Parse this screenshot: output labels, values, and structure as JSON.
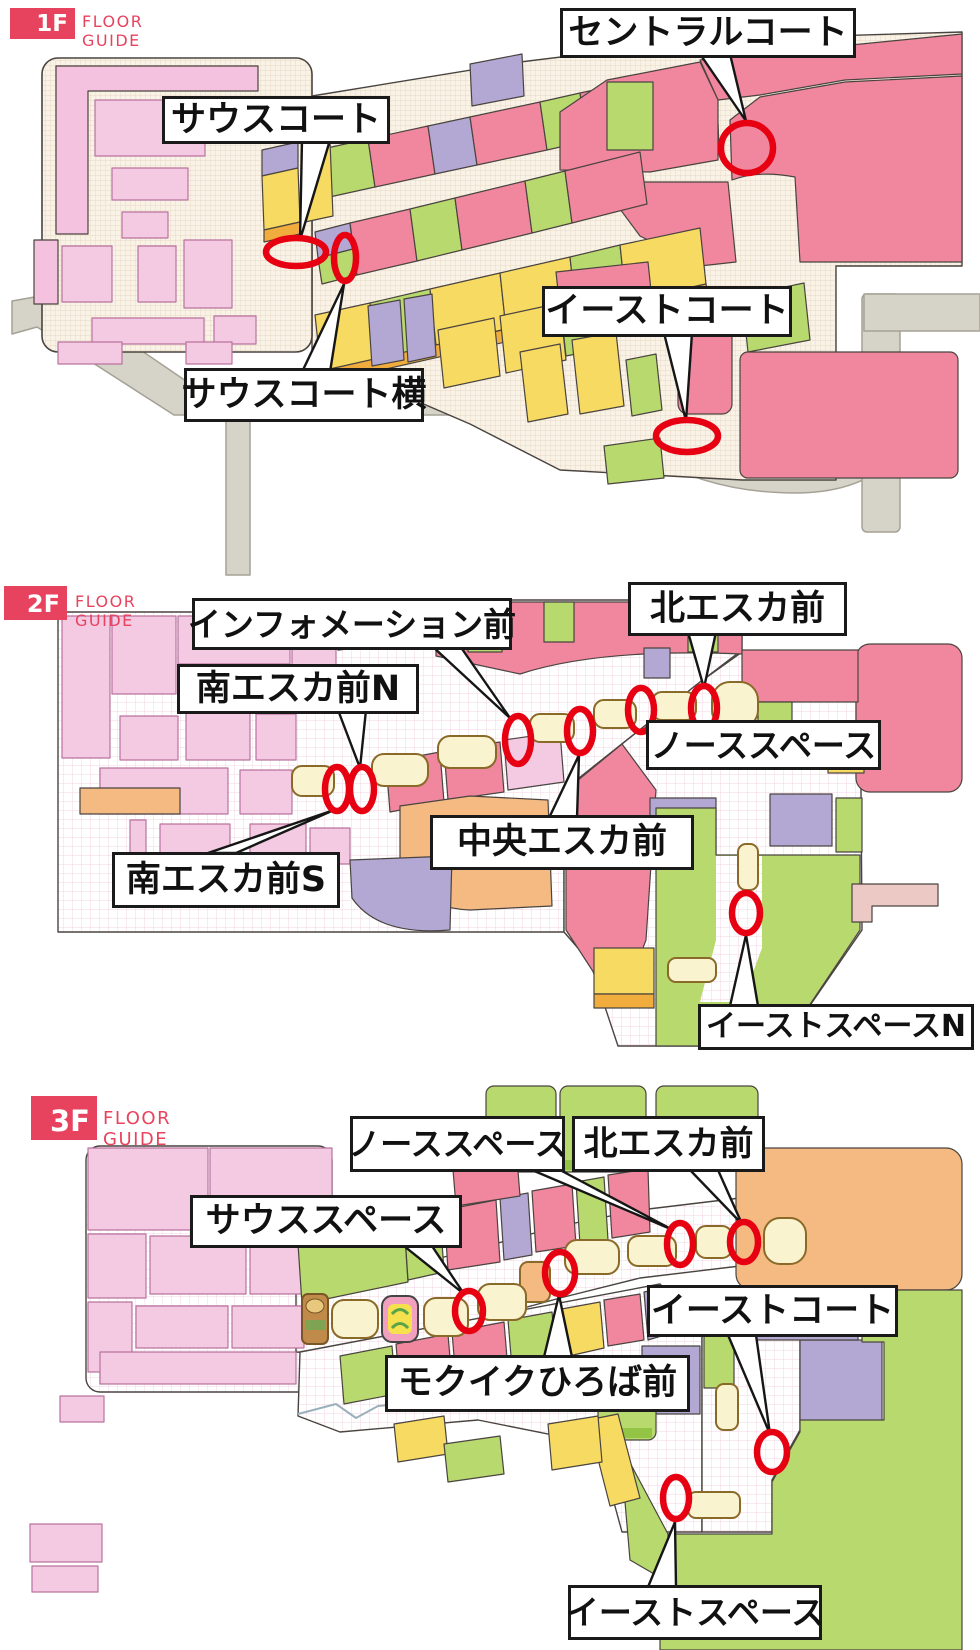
{
  "colors": {
    "accent": "#e8435e",
    "marker_red": "#e60012"
  },
  "floors": [
    {
      "badge": "1F",
      "subtitle": "FLOOR GUIDE",
      "callouts": [
        {
          "id": "south-court",
          "label": "サウスコート"
        },
        {
          "id": "central-court",
          "label": "セントラルコート"
        },
        {
          "id": "south-court-side",
          "label": "サウスコート横"
        },
        {
          "id": "east-court",
          "label": "イーストコート"
        }
      ]
    },
    {
      "badge": "2F",
      "subtitle": "FLOOR GUIDE",
      "callouts": [
        {
          "id": "information-front",
          "label": "インフォメーション前"
        },
        {
          "id": "north-escalator-front",
          "label": "北エスカ前"
        },
        {
          "id": "south-escalator-front-n",
          "label": "南エスカ前N"
        },
        {
          "id": "north-space",
          "label": "ノーススペース"
        },
        {
          "id": "central-escalator-front",
          "label": "中央エスカ前"
        },
        {
          "id": "south-escalator-front-s",
          "label": "南エスカ前S"
        },
        {
          "id": "east-space-n",
          "label": "イーストスペースN"
        }
      ]
    },
    {
      "badge": "3F",
      "subtitle": "FLOOR GUIDE",
      "callouts": [
        {
          "id": "north-space",
          "label": "ノーススペース"
        },
        {
          "id": "north-escalator-front",
          "label": "北エスカ前"
        },
        {
          "id": "south-space",
          "label": "サウススペース"
        },
        {
          "id": "east-court",
          "label": "イーストコート"
        },
        {
          "id": "mokuiku-hiroba-front",
          "label": "モクイクひろば前"
        },
        {
          "id": "east-space",
          "label": "イーストスペース"
        }
      ]
    }
  ]
}
